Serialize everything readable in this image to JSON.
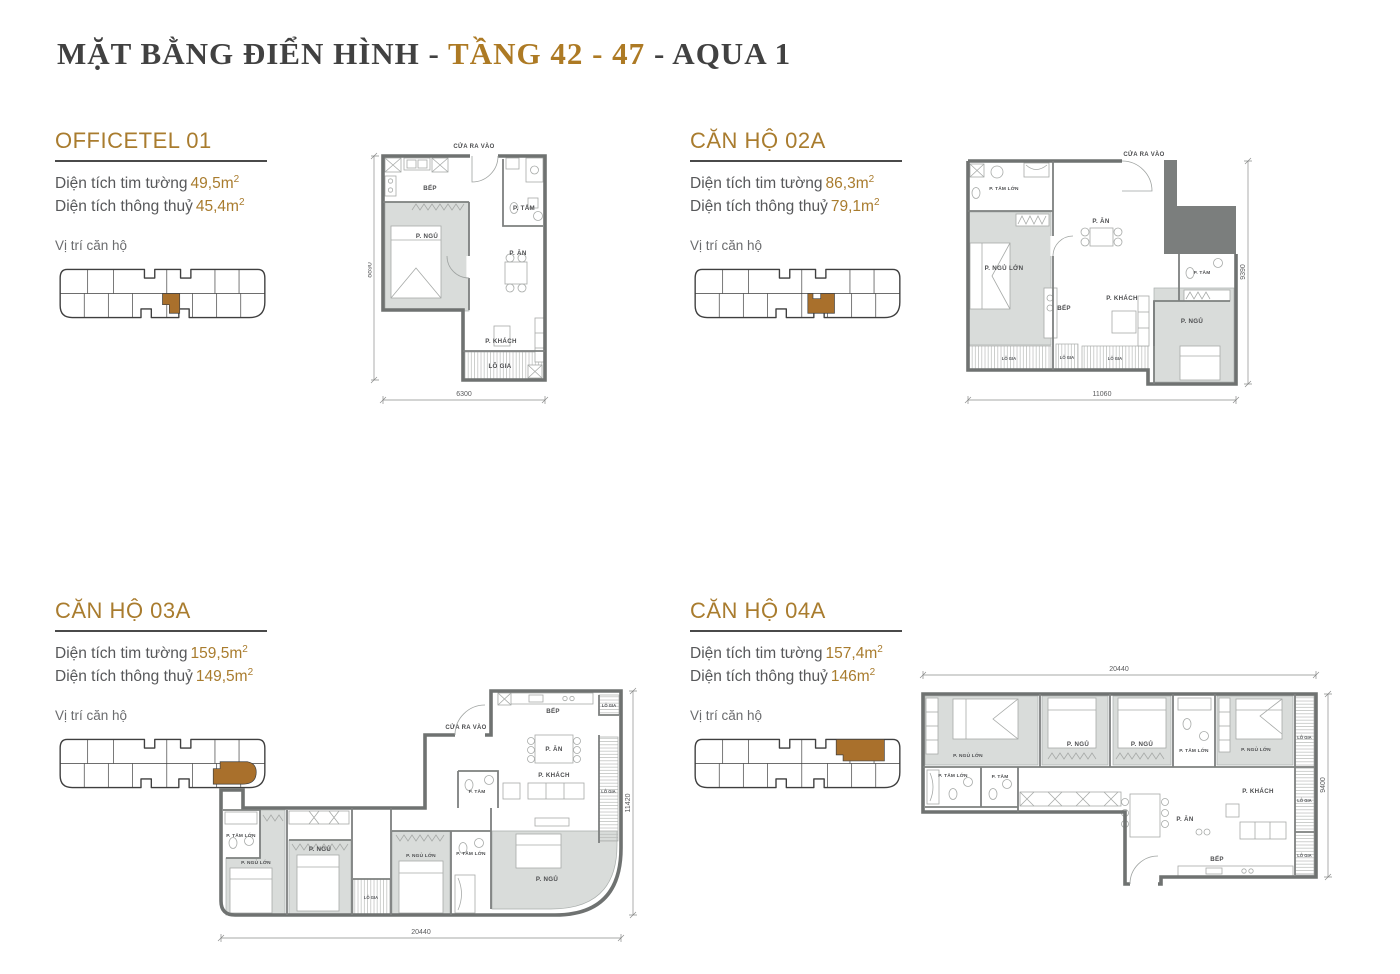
{
  "page": {
    "title_prefix": "MẶT BẰNG ĐIỂN HÌNH - ",
    "title_highlight": "TẦNG 42 - 47",
    "title_suffix": " - AQUA 1"
  },
  "labels": {
    "area_wall": "Diện tích tim tường",
    "area_clear": "Diện tích thông thuỷ",
    "sup": "2",
    "location": "Vị trí căn hộ"
  },
  "colors": {
    "accent": "#a97c2e",
    "highlight": "#a9702c",
    "title_dark": "#414141",
    "wall_gray": "#6f7271",
    "room_fill": "#d9dcda"
  },
  "units": [
    {
      "name": "OFFICETEL 01",
      "area_wall": "49,5m",
      "area_clear": "45,4m"
    },
    {
      "name": "CĂN HỘ 02A",
      "area_wall": "86,3m",
      "area_clear": "79,1m"
    },
    {
      "name": "CĂN HỘ 03A",
      "area_wall": "159,5m",
      "area_clear": "149,5m"
    },
    {
      "name": "CĂN HỘ 04A",
      "area_wall": "157,4m",
      "area_clear": "146m"
    }
  ],
  "plans": {
    "p1": {
      "entrance": "CỬA RA VÀO",
      "dim_v": "8890",
      "dim_h": "6300",
      "bep": "BẾP",
      "ptam": "P. TẮM",
      "pngu": "P. NGỦ",
      "pan": "P. ĂN",
      "pkhach": "P. KHÁCH",
      "logia": "LÔ GIA"
    },
    "p2": {
      "entrance": "CỬA RA VÀO",
      "dim_h": "11060",
      "dim_v": "9390",
      "ptamlon": "P. TẮM LỚN",
      "pngulon": "P. NGỦ LỚN",
      "pan": "P. ĂN",
      "bep": "BẾP",
      "pkhach": "P. KHÁCH",
      "ptam": "P. TẮM",
      "pngu": "P. NGỦ",
      "logia1": "LÔ GIA",
      "logia2": "LÔ GIA",
      "logia3": "LÔ GIA"
    },
    "p3": {
      "entrance": "CỬA RA VÀO",
      "dim_h": "20440",
      "dim_v": "11420",
      "bep": "BẾP",
      "logia_top": "LÔ GIA",
      "pan": "P. ĂN",
      "pkhach": "P. KHÁCH",
      "logia_right": "LÔ GIA",
      "ptam": "P. TẮM",
      "ptamlon1": "P. TẮM LỚN",
      "pngulon1": "P. NGỦ LỚN",
      "pngu1": "P. NGỦ",
      "logia_mid": "LÔ GIA",
      "pngulon2": "P. NGỦ LỚN",
      "ptamlon2": "P. TẮM LỚN",
      "pngu2": "P. NGỦ"
    },
    "p4": {
      "dim_h": "20440",
      "dim_v": "9400",
      "pngulon1": "P. NGỦ LỚN",
      "pngu1": "P. NGỦ",
      "pngu2": "P. NGỦ",
      "ptamlon_top": "P. TẮM LỚN",
      "pngulon2": "P. NGỦ LỚN",
      "logia1": "LÔ GIA",
      "logia2": "LÔ GIA",
      "logia3": "LÔ GIA",
      "ptamlon": "P. TẮM LỚN",
      "ptam": "P. TẮM",
      "pan": "P. ĂN",
      "pkhach": "P. KHÁCH",
      "bep": "BẾP"
    }
  }
}
